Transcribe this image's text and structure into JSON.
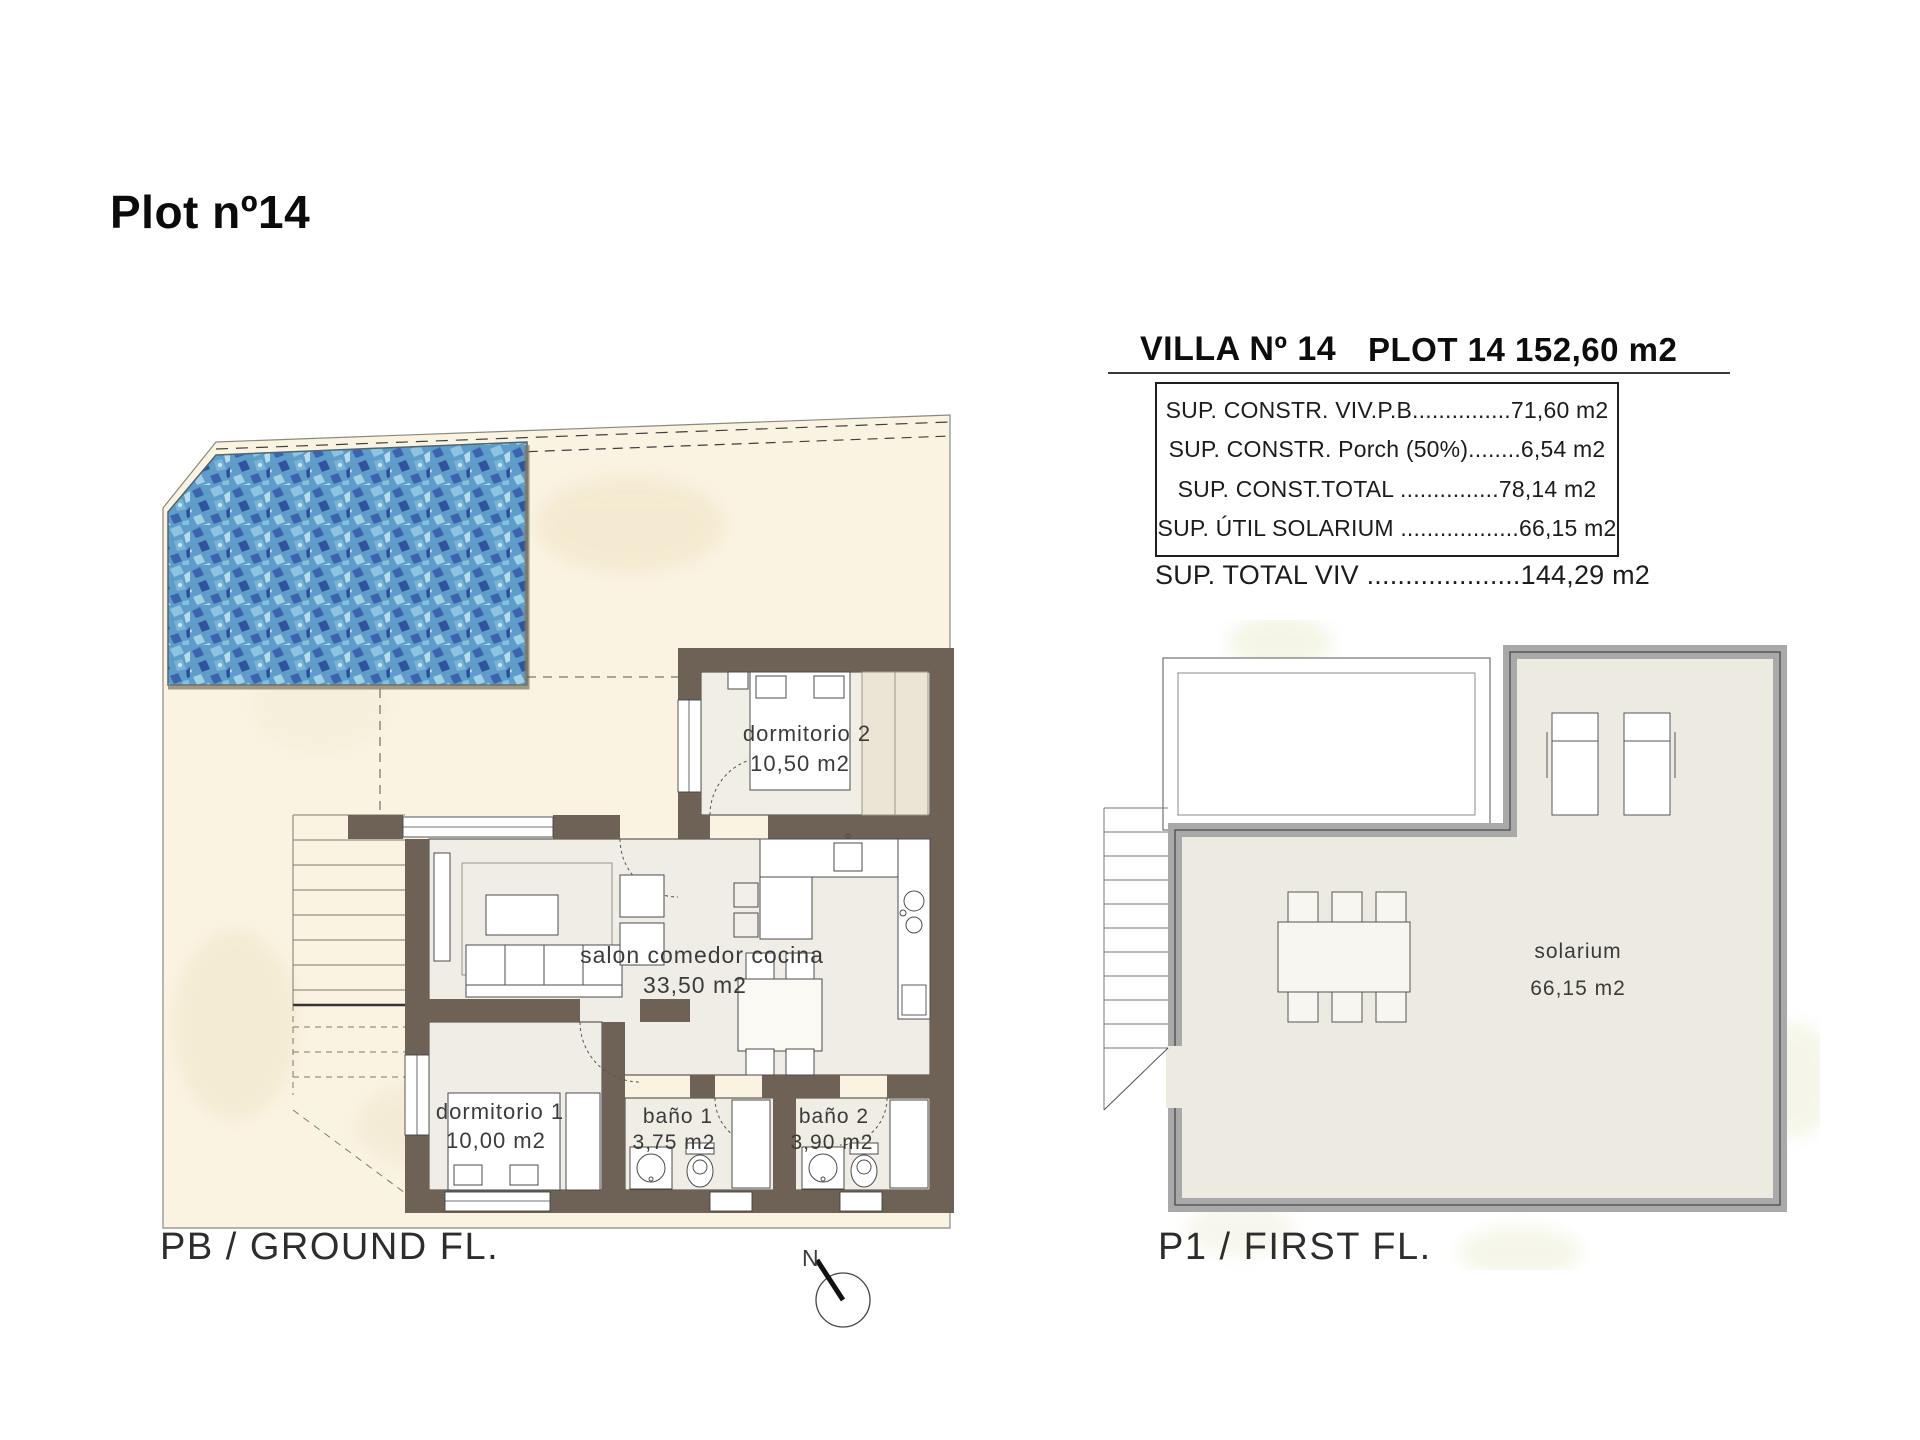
{
  "title": "Plot nº14",
  "header": {
    "villa_title": "VILLA Nº 14",
    "plot_title": "PLOT 14 152,60 m2",
    "table_rows": [
      "SUP. CONSTR. VIV.P.B...............71,60 m2",
      "SUP. CONSTR. Porch (50%)........6,54 m2",
      "SUP. CONST.TOTAL ...............78,14 m2",
      "SUP. ÚTIL SOLARIUM ..................66,15 m2"
    ],
    "total_row": "SUP. TOTAL VIV ....................144,29 m2"
  },
  "ground_floor": {
    "label": "PB / GROUND FL.",
    "compass_label": "N",
    "rooms": {
      "dormitorio2": {
        "name": "dormitorio 2",
        "area": "10,50 m2"
      },
      "salon": {
        "name": "salon comedor cocina",
        "area": "33,50 m2"
      },
      "dormitorio1": {
        "name": "dormitorio 1",
        "area": "10,00 m2"
      },
      "bano1": {
        "name": "baño 1",
        "area": "3,75 m2"
      },
      "bano2": {
        "name": "baño 2",
        "area": "3,90 m2"
      }
    }
  },
  "first_floor": {
    "label": "P1 / FIRST FL.",
    "rooms": {
      "solarium": {
        "name": "solarium",
        "area": "66,15 m2"
      }
    }
  },
  "colors": {
    "wall_ground_floor": "#6e6257",
    "wall_first_floor": "#a9a9a9",
    "plot_fill": "#faf3e2",
    "interior_floor": "#efede6",
    "pool_base_blue": "#5e9dc9",
    "pool_dark_blue": "#31529c",
    "line_color": "#3c3c3c"
  }
}
